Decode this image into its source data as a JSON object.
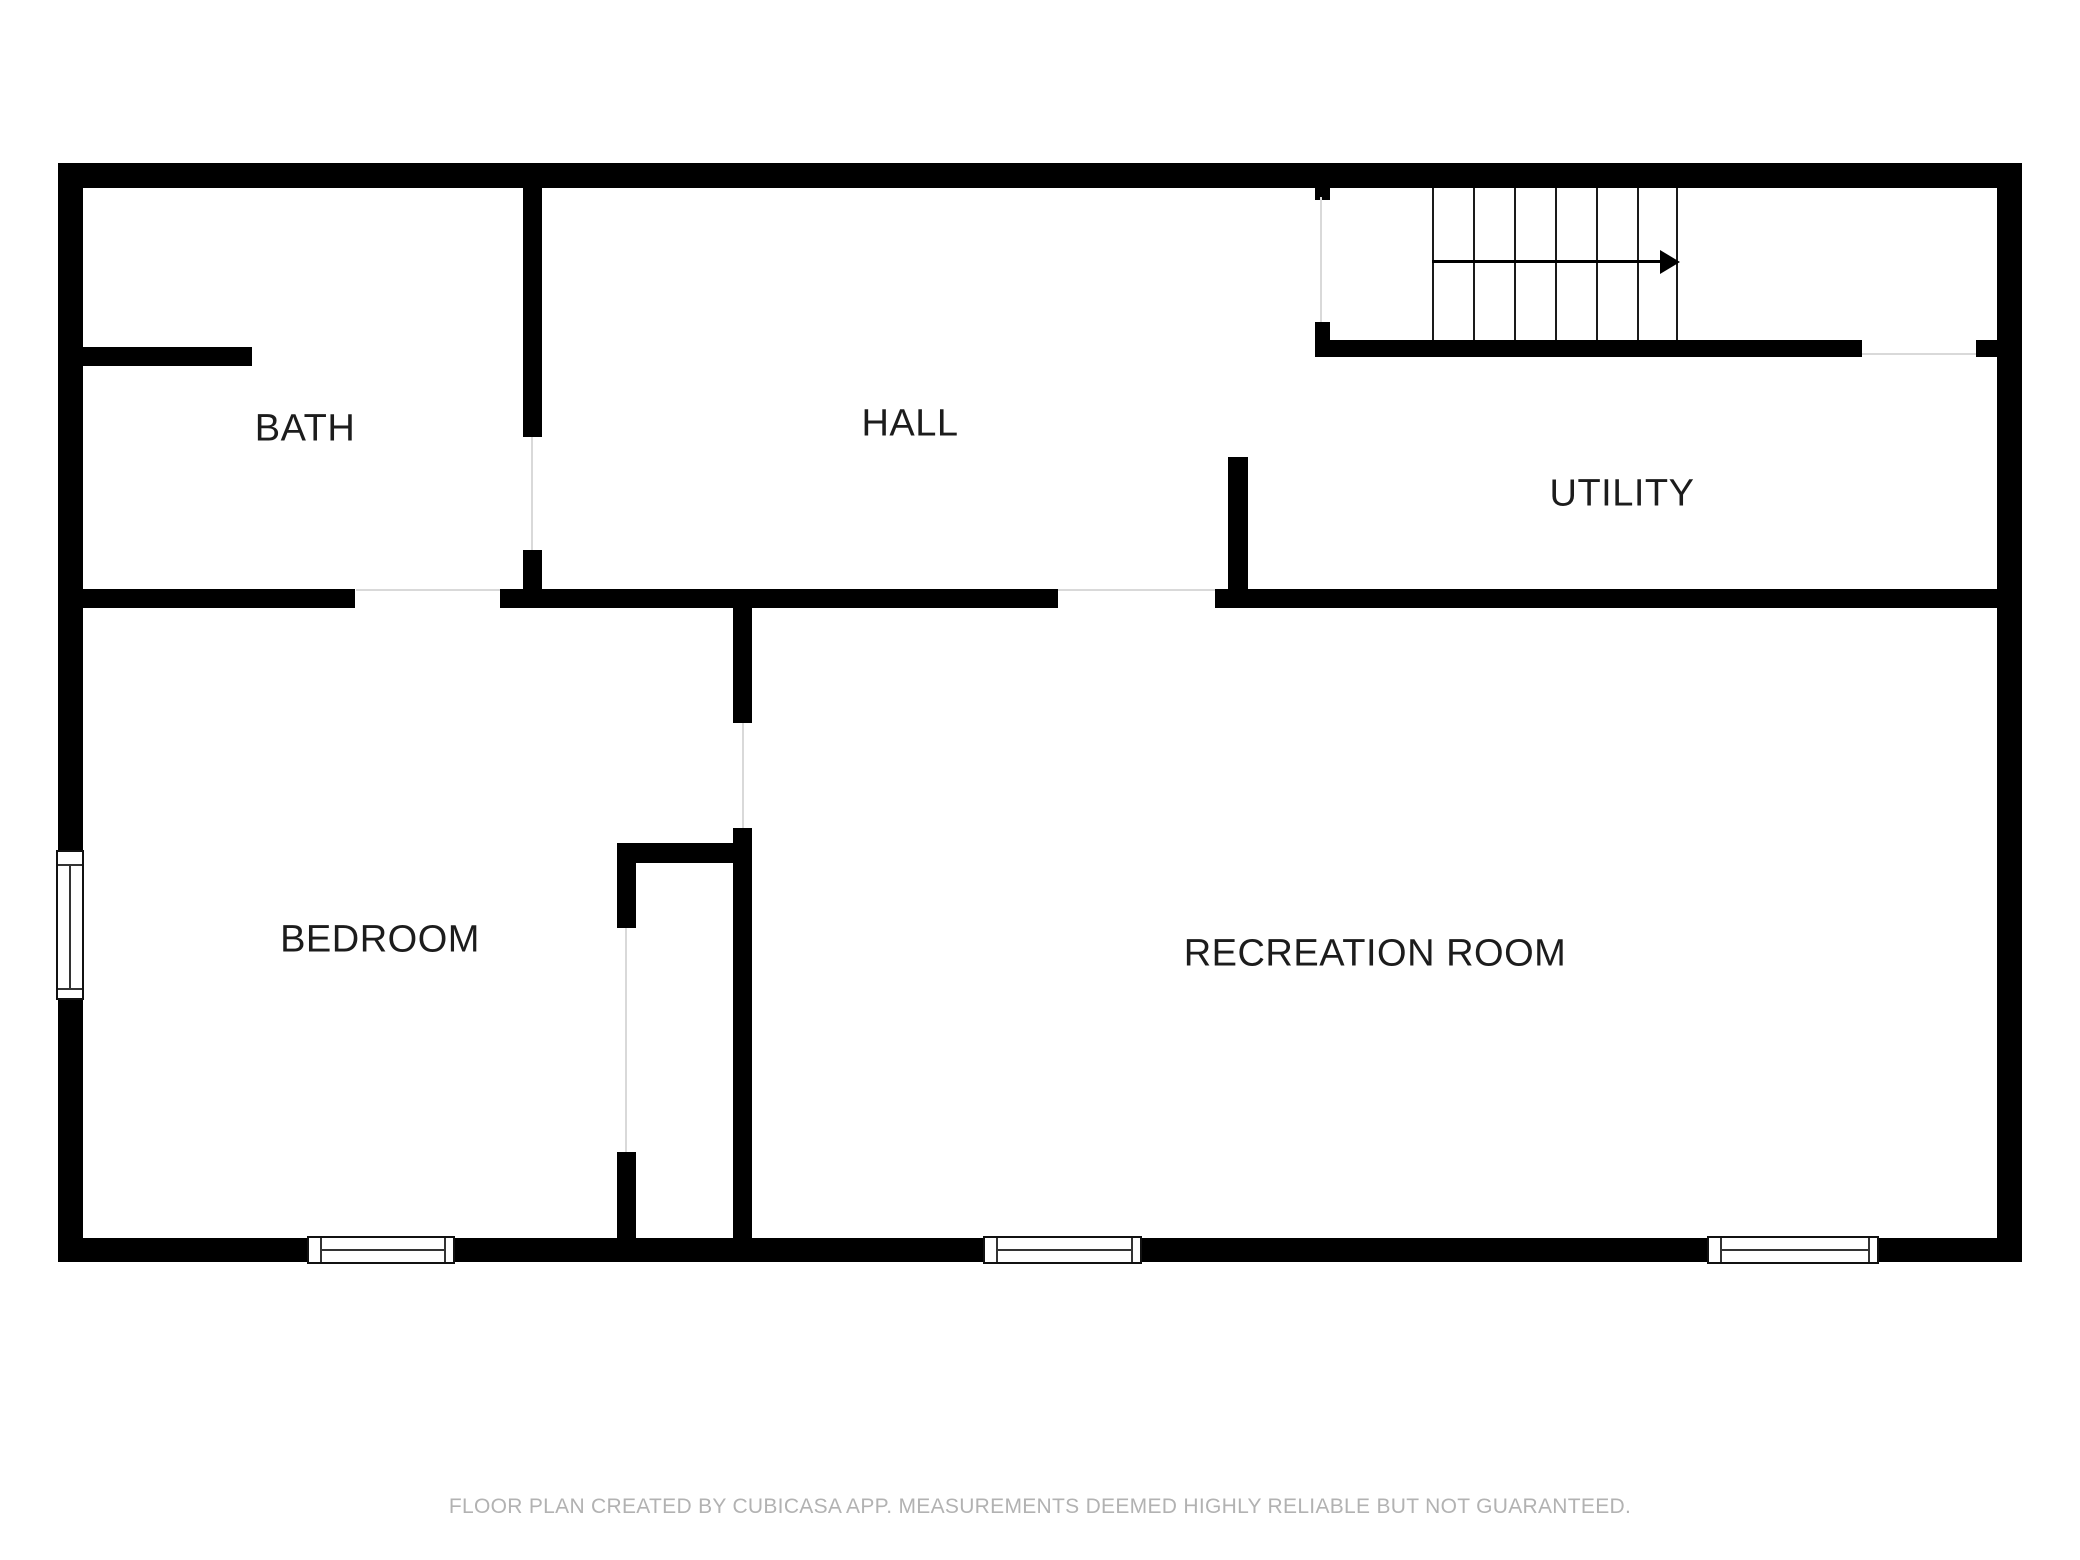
{
  "floor_plan": {
    "rooms": [
      {
        "id": "bath",
        "label": "BATH"
      },
      {
        "id": "hall",
        "label": "HALL"
      },
      {
        "id": "utility",
        "label": "UTILITY"
      },
      {
        "id": "bedroom",
        "label": "BEDROOM"
      },
      {
        "id": "recreation_room",
        "label": "RECREATION ROOM"
      }
    ],
    "stairs": {
      "direction": "right",
      "treads": 6,
      "icon": "right-arrow-icon"
    },
    "windows": {
      "count": 4
    },
    "footer": "FLOOR PLAN CREATED BY CUBICASA APP. MEASUREMENTS DEEMED HIGHLY RELIABLE BUT NOT GUARANTEED.",
    "colors": {
      "wall": "#000000",
      "background": "#ffffff",
      "label": "#1c1c1c",
      "footer_text": "#b2b2b2",
      "door_threshold": "#d9d9d9"
    }
  }
}
